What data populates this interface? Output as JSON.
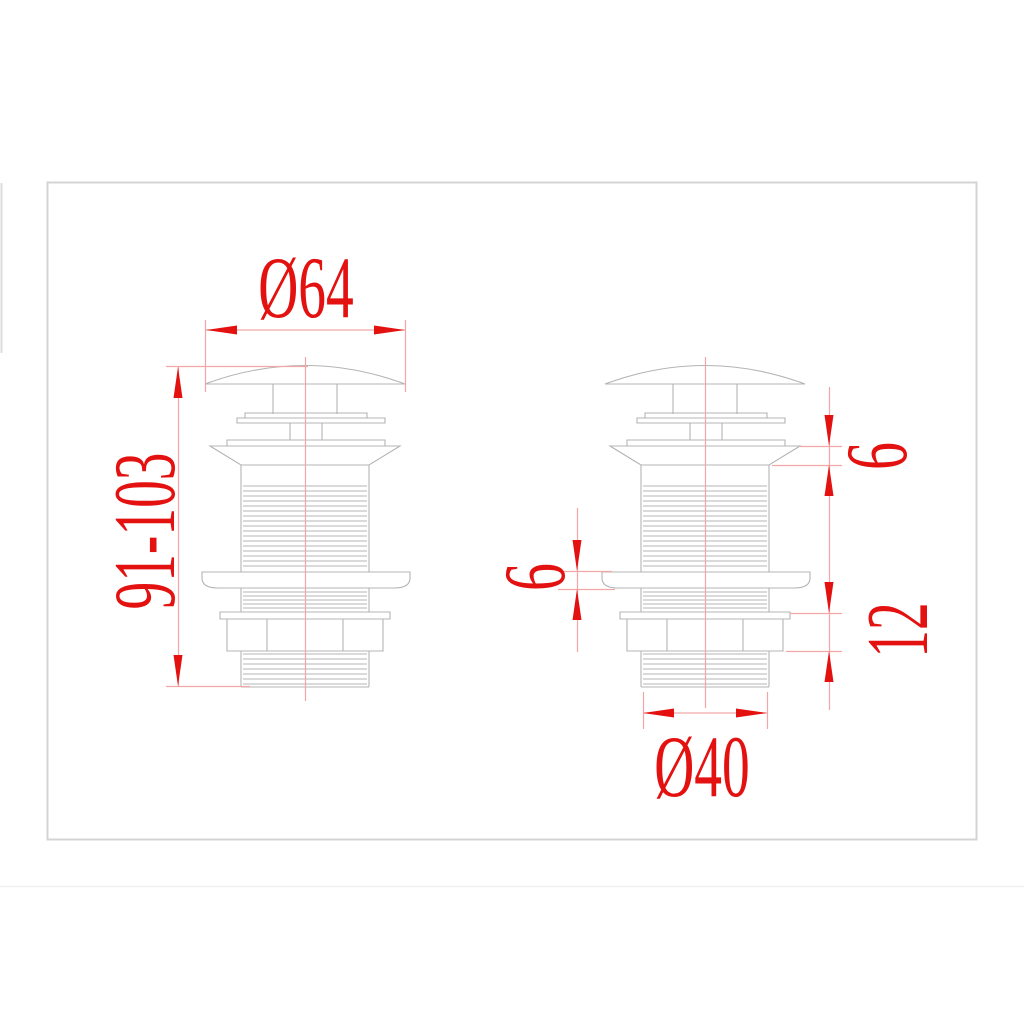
{
  "drawing": {
    "type": "technical-dimension-drawing",
    "subject": "pop-up basin drain plug, two orthographic views",
    "colors": {
      "accent": "#e41111",
      "dim_line": "#f2a6a6",
      "part_line": "#b4b4b4",
      "frame": "#d4d4d4"
    },
    "labels": {
      "top_diameter": "Ø64",
      "height_range": "91-103",
      "flange_height": "6",
      "washer_thickness": "6",
      "locknut_height": "12",
      "bottom_diameter": "Ø40"
    }
  }
}
